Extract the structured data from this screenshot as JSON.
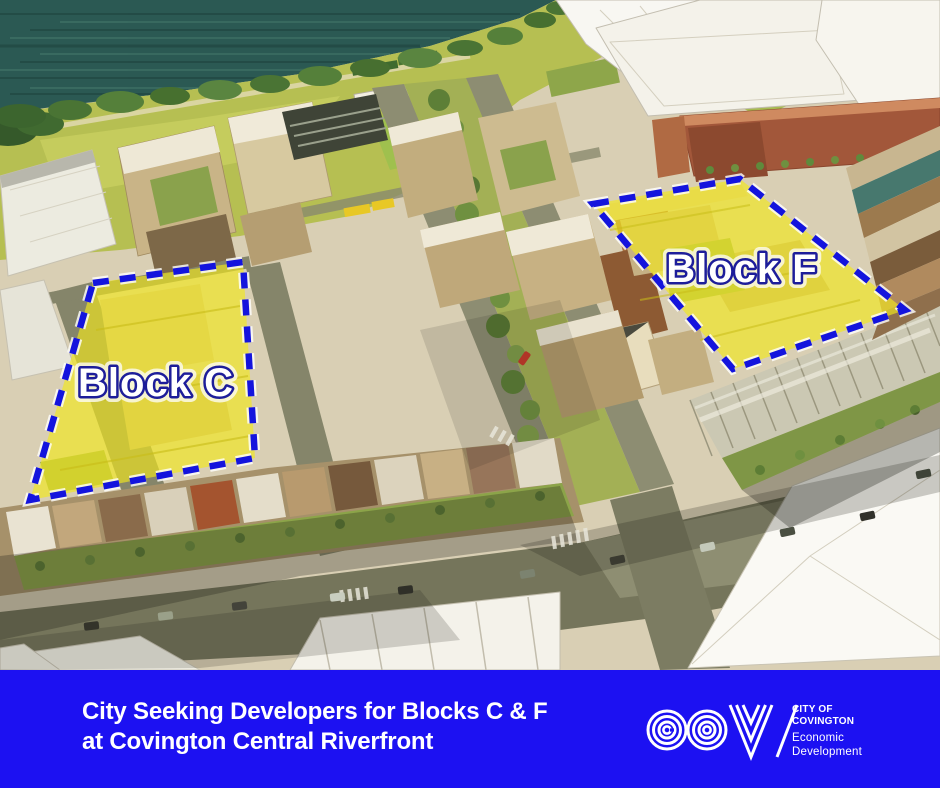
{
  "map": {
    "block_c_label": "Block C",
    "block_f_label": "Block F"
  },
  "banner": {
    "headline_line1": "City Seeking Developers for Blocks C & F",
    "headline_line2": "at Covington Central Riverfront",
    "logo": {
      "monogram": "COV",
      "org_line1": "CITY OF",
      "org_line2": "COVINGTON",
      "dept_line1": "Economic",
      "dept_line2": "Development"
    }
  },
  "colors": {
    "banner_blue": "#1c11f2",
    "highlight_yellow": "#f2e71e",
    "outline_blue": "#1414dd",
    "label_navy": "#1d1d9a",
    "water_teal": "#2b5953"
  }
}
